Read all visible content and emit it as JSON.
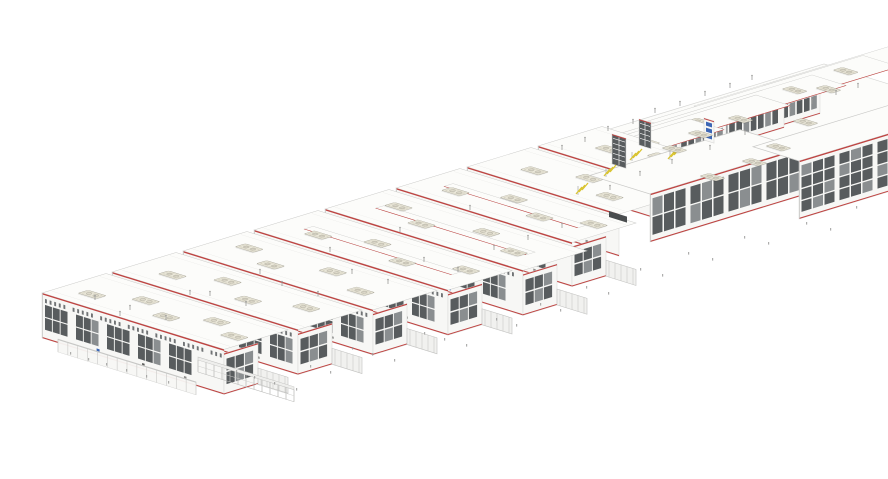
{
  "scene": {
    "width": 888,
    "height": 479,
    "background": "#ffffff",
    "description": "Axonometric architectural rendering of an elongated industrial building complex: an echelon of white factory bars with red parapet trim, dark glazed facades, beige rooftop HVAC units, connecting wings and yellow roof stairs"
  },
  "projection": {
    "u_slope": 0.31,
    "v_slope": -0.305
  },
  "palette": {
    "roof": "#fcfcfa",
    "roofEdge": "#c9c9c7",
    "roofJoint": "#e9e9e7",
    "wall": "#f7f7f5",
    "wallEdge": "#d8d8d6",
    "red": "#bf4341",
    "winDark": "#585c5e",
    "winMid": "#8a8e90",
    "mullion": "#ffffff",
    "beige": "#ebe8da",
    "beigeEdge": "#aaa79a",
    "beigeInner": "#c9c5b4",
    "beigeFan": "#dedacb",
    "yellow": "#d9c431",
    "blue": "#3c66b5",
    "link": "#f1f1ef",
    "linkEdge": "#c2c2c0",
    "tick": "#9a9a98",
    "dark": "#4a4d4f",
    "shadow": "rgba(0,0,0,0.08)"
  },
  "back_roof": {
    "points": [
      [
        600,
        132
      ],
      [
        726,
        171
      ],
      [
        950,
        103
      ],
      [
        824,
        64
      ]
    ]
  },
  "bars": [
    {
      "id": "bar-1",
      "p": [
        42,
        293
      ],
      "len": 182,
      "h": 45,
      "dep": 64,
      "gable": true,
      "link": true,
      "ridge": false,
      "blue": [
        0.3
      ],
      "units": [
        [
          0.1,
          0.28
        ],
        [
          0.3,
          0.55
        ],
        [
          0.5,
          0.3
        ],
        [
          0.68,
          0.58
        ],
        [
          0.86,
          0.34
        ]
      ]
    },
    {
      "id": "bar-2",
      "p": [
        112,
        272
      ],
      "len": 186,
      "h": 45,
      "dep": 64,
      "gable": true,
      "link": true,
      "ridge": false,
      "blue": [
        0.3
      ],
      "units": [
        [
          0.14,
          0.32
        ],
        [
          0.34,
          0.6
        ],
        [
          0.56,
          0.28
        ],
        [
          0.78,
          0.55
        ]
      ]
    },
    {
      "id": "bar-3",
      "p": [
        183,
        251
      ],
      "len": 190,
      "h": 45,
      "dep": 64,
      "gable": true,
      "link": true,
      "ridge": false,
      "blue": [
        0.32
      ],
      "units": [
        [
          0.1,
          0.52
        ],
        [
          0.3,
          0.26
        ],
        [
          0.52,
          0.58
        ],
        [
          0.76,
          0.3
        ]
      ]
    },
    {
      "id": "bar-4",
      "p": [
        254,
        230
      ],
      "len": 194,
      "h": 45,
      "dep": 64,
      "gable": true,
      "link": true,
      "ridge": true,
      "blue": [
        0.3
      ],
      "units": [
        [
          0.16,
          0.3
        ],
        [
          0.38,
          0.56
        ],
        [
          0.6,
          0.28
        ],
        [
          0.83,
          0.58
        ]
      ]
    },
    {
      "id": "bar-5",
      "p": [
        325,
        209
      ],
      "len": 198,
      "h": 45,
      "dep": 64,
      "gable": true,
      "link": true,
      "ridge": true,
      "blue": [
        0.28,
        0.62
      ],
      "units": [
        [
          0.12,
          0.56
        ],
        [
          0.32,
          0.3
        ],
        [
          0.55,
          0.6
        ],
        [
          0.78,
          0.32
        ]
      ]
    },
    {
      "id": "bar-6",
      "p": [
        396,
        188
      ],
      "len": 176,
      "h": 44,
      "dep": 64,
      "gable": true,
      "link": true,
      "ridge": true,
      "blue": [
        0.3
      ],
      "units": [
        [
          0.15,
          0.3
        ],
        [
          0.38,
          0.58
        ],
        [
          0.62,
          0.32
        ],
        [
          0.84,
          0.56
        ]
      ]
    },
    {
      "id": "bar-7",
      "p": [
        467,
        167
      ],
      "len": 152,
      "h": 42,
      "dep": 64,
      "gable": false,
      "link": false,
      "ridge": false,
      "blue": [
        0.34
      ],
      "units": [
        [
          0.2,
          0.36
        ],
        [
          0.46,
          0.6
        ],
        [
          0.72,
          0.3
        ]
      ]
    },
    {
      "id": "bar-8",
      "p": [
        538,
        146
      ],
      "len": 112,
      "h": 36,
      "dep": 64,
      "gable": false,
      "link": false,
      "ridge": false,
      "blue": [],
      "units": [
        [
          0.28,
          0.4
        ],
        [
          0.62,
          0.62
        ]
      ]
    }
  ],
  "stub": {
    "id": "bar-9",
    "p": [
      806,
      132
    ],
    "len": 82,
    "h": 26,
    "dep": 40,
    "rows": 1,
    "units": [
      [
        0.4,
        0.5
      ]
    ]
  },
  "wings": [
    {
      "id": "wing-1",
      "p": [
        510,
        196
      ],
      "wU": 34,
      "lenV": 80,
      "h": 22,
      "roofLen": 180,
      "units": [
        0.35,
        0.65
      ]
    },
    {
      "id": "wing-2",
      "p": [
        556,
        180
      ],
      "wU": 34,
      "lenV": 90,
      "h": 24,
      "roofLen": 200,
      "units": [
        0.32,
        0.62
      ]
    },
    {
      "id": "wing-3",
      "p": [
        602,
        163
      ],
      "wU": 34,
      "lenV": 90,
      "h": 24,
      "roofLen": 210,
      "units": [
        0.3,
        0.58,
        0.82
      ]
    },
    {
      "id": "wing-4",
      "p": [
        648,
        147
      ],
      "wU": 36,
      "lenV": 100,
      "h": 26,
      "roofLen": 215,
      "units": [
        0.3,
        0.58,
        0.82
      ]
    },
    {
      "id": "wing-5",
      "p": [
        694,
        130
      ],
      "wU": 36,
      "lenV": 90,
      "h": 24,
      "roofLen": 200,
      "units": [
        0.35,
        0.65
      ]
    }
  ],
  "halls": [
    {
      "id": "hall-east-1",
      "p": [
        650,
        242
      ],
      "lenV": 150,
      "h": 48,
      "rows": 2,
      "depU": 60
    },
    {
      "id": "hall-east-2",
      "p": [
        799,
        219
      ],
      "lenV": 150,
      "h": 58,
      "rows": 4,
      "depU": 46
    }
  ],
  "towers": [
    {
      "id": "tower-dark-1",
      "p": [
        612,
        134
      ],
      "w": 14,
      "h": 30,
      "style": "dark"
    },
    {
      "id": "tower-dark-2",
      "p": [
        639,
        119
      ],
      "w": 12,
      "h": 26,
      "style": "dark"
    },
    {
      "id": "tower-blue",
      "p": [
        704,
        118
      ],
      "w": 10,
      "h": 22,
      "style": "blue"
    }
  ],
  "stairs": [
    [
      576,
      190
    ],
    [
      604,
      172
    ],
    [
      630,
      156
    ],
    [
      668,
      155
    ]
  ],
  "dock": {
    "p": [
      609,
      211
    ],
    "w": 18,
    "h": 6
  },
  "canopy": {
    "p": [
      58,
      339
    ],
    "len": 138,
    "h": 13,
    "posts": 14
  },
  "scaffold": {
    "p": [
      198,
      357
    ],
    "len": 96,
    "h": 15,
    "posts": 12
  },
  "free_units": [
    [
      700,
      176
    ],
    [
      742,
      161
    ],
    [
      793,
      121
    ],
    [
      688,
      133
    ],
    [
      728,
      118
    ],
    [
      766,
      146
    ],
    [
      816,
      88
    ],
    [
      662,
      148
    ]
  ],
  "antennas": [
    [
      562,
      150
    ],
    [
      585,
      142
    ],
    [
      608,
      131
    ],
    [
      633,
      124
    ],
    [
      655,
      113
    ],
    [
      680,
      106
    ],
    [
      705,
      96
    ],
    [
      730,
      88
    ],
    [
      752,
      80
    ],
    [
      790,
      112
    ],
    [
      812,
      104
    ],
    [
      836,
      95
    ],
    [
      858,
      88
    ],
    [
      745,
      135
    ],
    [
      710,
      150
    ],
    [
      672,
      164
    ],
    [
      640,
      176
    ],
    [
      610,
      190
    ],
    [
      95,
      300
    ],
    [
      130,
      310
    ],
    [
      166,
      320
    ],
    [
      210,
      296
    ],
    [
      246,
      306
    ],
    [
      282,
      286
    ],
    [
      318,
      296
    ],
    [
      352,
      274
    ],
    [
      388,
      284
    ],
    [
      424,
      262
    ],
    [
      458,
      272
    ],
    [
      494,
      250
    ],
    [
      528,
      240
    ],
    [
      562,
      228
    ],
    [
      470,
      210
    ],
    [
      400,
      232
    ],
    [
      330,
      252
    ],
    [
      260,
      274
    ],
    [
      190,
      295
    ],
    [
      120,
      316
    ]
  ],
  "ground_ticks": [
    [
      70,
      352
    ],
    [
      88,
      358
    ],
    [
      106,
      363
    ],
    [
      126,
      369
    ],
    [
      146,
      375
    ],
    [
      168,
      381
    ],
    [
      236,
      370
    ],
    [
      254,
      376
    ],
    [
      274,
      382
    ],
    [
      296,
      388
    ],
    [
      310,
      365
    ],
    [
      330,
      371
    ],
    [
      352,
      347
    ],
    [
      372,
      353
    ],
    [
      394,
      359
    ],
    [
      424,
      332
    ],
    [
      444,
      338
    ],
    [
      466,
      344
    ],
    [
      496,
      318
    ],
    [
      516,
      324
    ],
    [
      540,
      303
    ],
    [
      560,
      309
    ],
    [
      586,
      286
    ],
    [
      608,
      292
    ],
    [
      640,
      268
    ],
    [
      662,
      274
    ],
    [
      688,
      252
    ],
    [
      712,
      258
    ],
    [
      744,
      236
    ],
    [
      768,
      242
    ],
    [
      806,
      222
    ],
    [
      830,
      228
    ],
    [
      856,
      206
    ]
  ]
}
